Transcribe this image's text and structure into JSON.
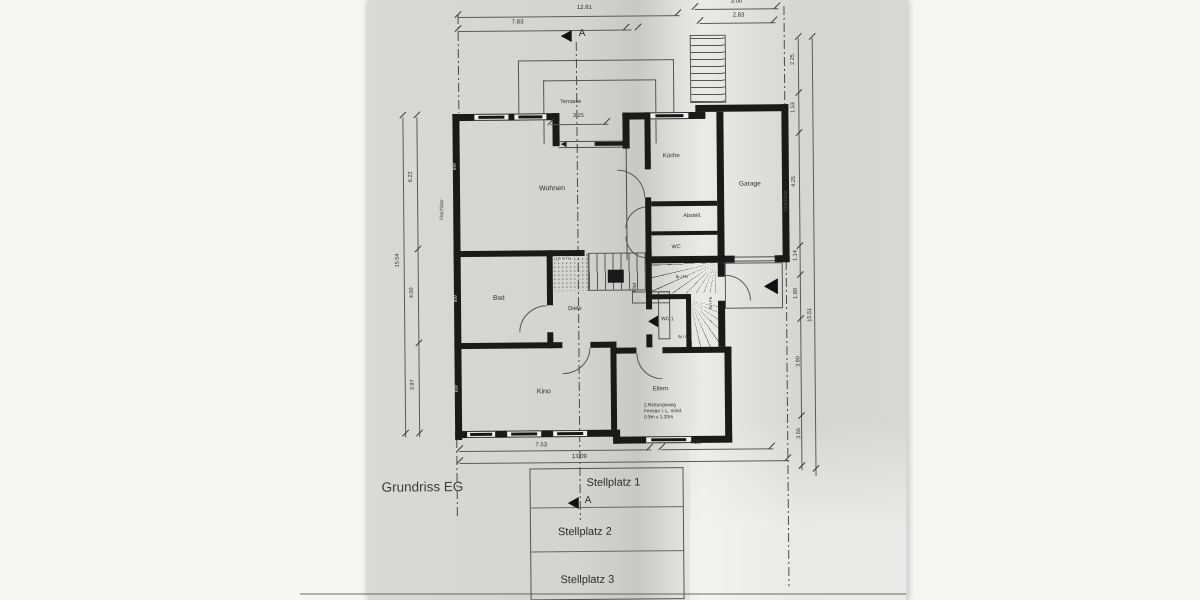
{
  "title": "Grundriss EG",
  "section": {
    "a": "A"
  },
  "rooms": {
    "terrasse": "Terrasse",
    "wohnen": "Wohnen",
    "kueche": "Küche",
    "garage": "Garage",
    "abstell": "Abstell.",
    "wc": "WC",
    "bad": "Bad",
    "diele": "Diele",
    "flur": "Flur",
    "wc1": "WC 1",
    "kino": "Kino",
    "eltern": "Eltern"
  },
  "stairs": {
    "main": "16 STG"
  },
  "marks": {
    "bw": "BW",
    "fb": "fb / Fb",
    "nachbar": "Nachbar"
  },
  "note": {
    "l1": "2.Rettungsweg",
    "l2": "Fenster l. L.  mind.",
    "l3": "0.9m x 1.20m"
  },
  "parking": {
    "p1": "Stellplatz 1",
    "p2": "Stellplatz 2",
    "p3": "Stellplatz 3"
  },
  "dims": {
    "top_total": "12.61",
    "top_seg": "7.83",
    "top_right_total": "3.00",
    "top_right_seg": "2.83",
    "terrasse_w": "3.25",
    "bottom_seg": "7.53",
    "bottom_seg2": "4.26",
    "bottom_total": "13.09",
    "left_a": "6.22",
    "left_total": "15.54",
    "left_b": "4.00",
    "left_c": "3.97",
    "right_a": "2.25",
    "right_b": "1.53",
    "right_c": "4.25",
    "right_d": "1.14",
    "right_e": "1.80",
    "right_f": "3.90",
    "right_g": "3.55",
    "right_total": "15.51"
  }
}
